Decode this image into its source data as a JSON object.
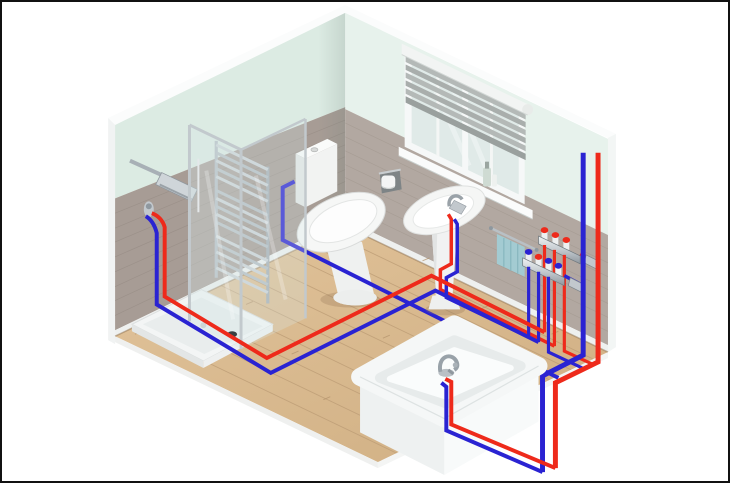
{
  "illustration": {
    "kind": "isometric-bathroom-plumbing-diagram",
    "description_present_in_pixels": false
  },
  "colors": {
    "hot": "#ee2a1b",
    "cold": "#2a23d2",
    "wall_mint_left": "#dcebe3",
    "wall_mint_right": "#e7f2ec",
    "tile_left": "#a79c95",
    "tile_right": "#b2a8a1",
    "tile_line": "#968b84",
    "skirting": "#eef0ef",
    "edge_white": "#fbfcfc",
    "wood": "#d9b98e",
    "wood_line": "#bd9d76",
    "chrome": "#b6bec4",
    "chrome_dark": "#8e979e",
    "fixture_white": "#f4f5f5",
    "fixture_shade": "#e6e8e7",
    "glass_tint": "#d7e8e8",
    "window_glass": "#e0eae8",
    "blind": "#aeb3b1",
    "towel": "#a3cbd2",
    "shadow": "#b79b74"
  },
  "scene": {
    "fixtures": [
      {
        "name": "shower-enclosure"
      },
      {
        "name": "towel-radiator"
      },
      {
        "name": "toilet"
      },
      {
        "name": "window-with-blind"
      },
      {
        "name": "pedestal-basin"
      },
      {
        "name": "towel-rail"
      },
      {
        "name": "hot-water-manifold"
      },
      {
        "name": "cold-water-manifold"
      },
      {
        "name": "bathtub"
      }
    ],
    "pipes": [
      {
        "name": "hot-supply",
        "color_key": "hot"
      },
      {
        "name": "cold-supply",
        "color_key": "cold"
      }
    ]
  }
}
